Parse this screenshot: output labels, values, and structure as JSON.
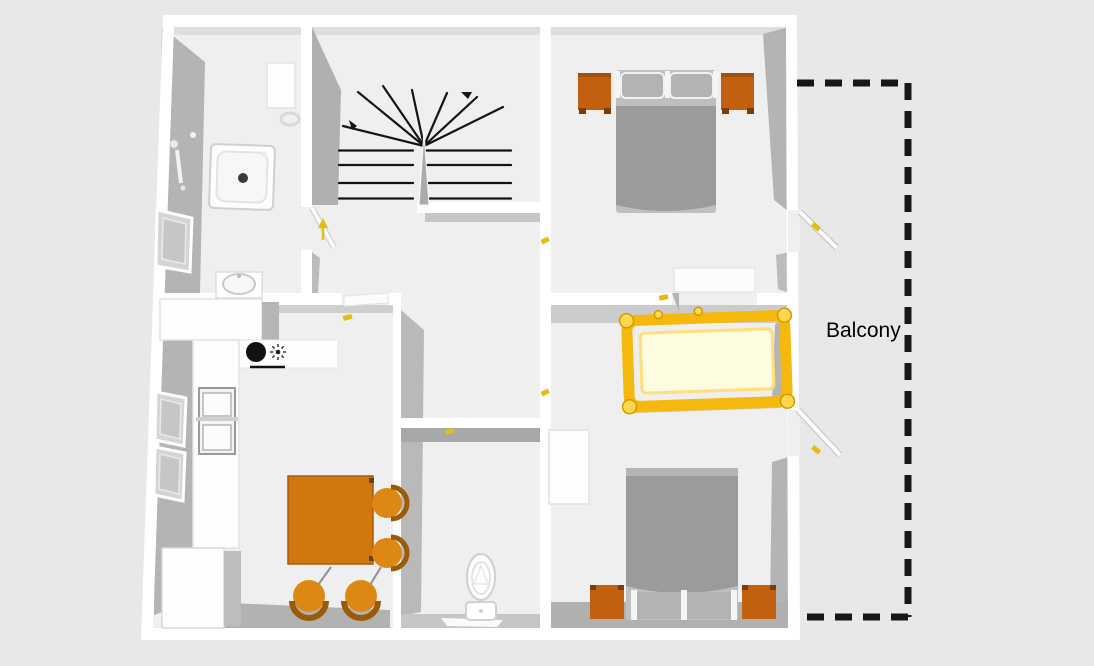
{
  "canvas": {
    "width": 1094,
    "height": 666,
    "background": "#e8e8e8",
    "floor": "#efefef",
    "wall": "#ffffff",
    "wall_shadow": "#b3b3b3"
  },
  "balcony": {
    "label": "Balcony",
    "outline_color": "#171717",
    "text_color": "#000000"
  },
  "colors": {
    "table": "#d2770d",
    "chair": "#dd8814",
    "chair_back": "#9a5a06",
    "nightstand": "#c2600f",
    "nightstand_leg": "#7e3c06",
    "bed_duvet": "#9b9b9b",
    "bed_mattress": "#bfbfbf",
    "pillow": "#b3b3b3",
    "crib_rail": "#f5b80c",
    "crib_knob": "#ffd84e",
    "crib_mattress": "#fdfbe0",
    "marker": "#e3bd13",
    "stair_line": "#141414",
    "cooktop": "#111111"
  },
  "furniture_icons": [
    "shower",
    "washbasin",
    "toilet",
    "staircase",
    "kitchen-counter",
    "cooktop",
    "gas-burner",
    "kitchen-sink",
    "fridge",
    "dining-table",
    "dining-chair",
    "double-bed",
    "nightstand",
    "crib",
    "wardrobe",
    "window",
    "door"
  ]
}
